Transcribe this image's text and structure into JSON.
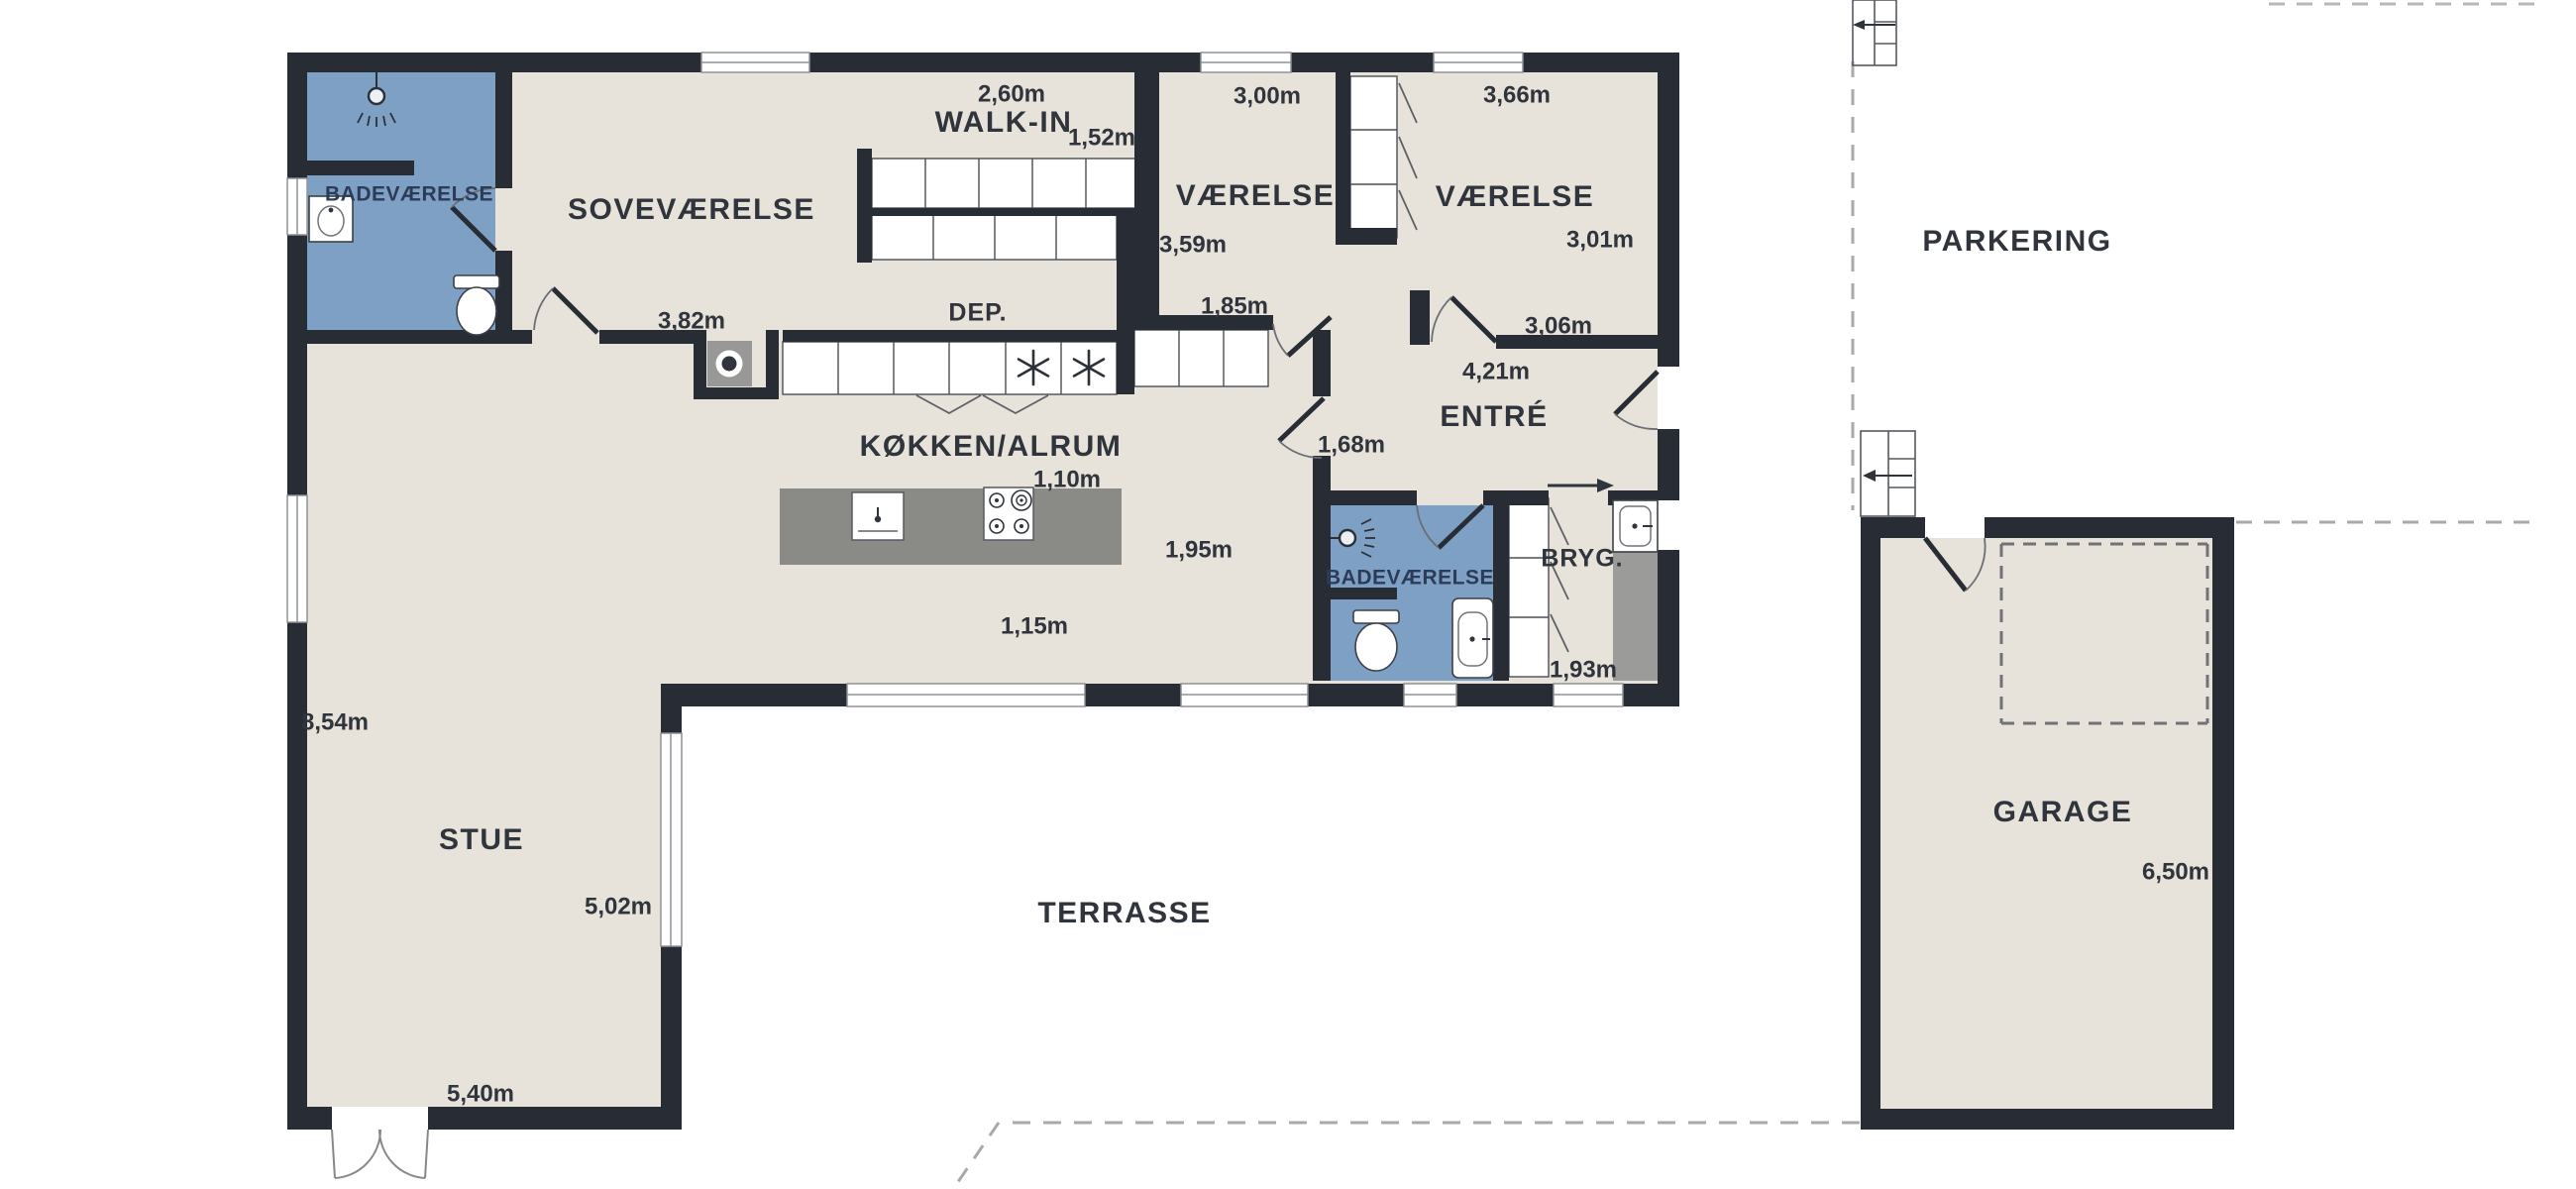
{
  "plan_title": "floor-plan",
  "rooms": {
    "bathroom1": "BADEVÆRELSE",
    "bedroom": "SOVEVÆRELSE",
    "walkin": "WALK-IN",
    "storage": "DEP.",
    "room1": "VÆRELSE",
    "room2": "VÆRELSE",
    "entry": "ENTRÉ",
    "kitchen": "KØKKEN/ALRUM",
    "bathroom2": "BADEVÆRELSE",
    "utility": "BRYG.",
    "living": "STUE",
    "terrace": "TERRASSE",
    "parking": "PARKERING",
    "garage": "GARAGE"
  },
  "measurements": {
    "walkin_width": "2,60m",
    "walkin_depth": "1,52m",
    "room1_width": "3,00m",
    "room1_depth": "3,59m",
    "room2_width": "3,66m",
    "room2_depth": "3,01m",
    "bedroom_width": "3,82m",
    "hall_width": "1,85m",
    "entry_top": "3,06m",
    "entry_width": "4,21m",
    "entry_left": "1,68m",
    "island_width": "1,10m",
    "kitchen_right": "1,95m",
    "kitchen_bottom": "1,15m",
    "utility_depth": "1,93m",
    "living_height": "8,54m",
    "living_right": "5,02m",
    "living_width": "5,40m",
    "garage_depth": "6,50m"
  },
  "colors": {
    "wall": "#282c35",
    "floor": "#e7e2da",
    "bathroom": "#7ea0c5",
    "island": "#8a8a86",
    "utility_band": "#9b9b99",
    "dashed_line": "#a7aaad",
    "garage_dash": "#6f7378",
    "text": "#30343c"
  },
  "icons": {
    "freezer": "snowflake-icon",
    "shower": "shower-head-icon",
    "toilet": "toilet-icon",
    "sink": "sink-icon",
    "washer": "washing-machine-icon",
    "stove": "stove-burners-icon",
    "stairs": "entry-steps-icon",
    "entry_direction": "arrow-right-icon"
  }
}
